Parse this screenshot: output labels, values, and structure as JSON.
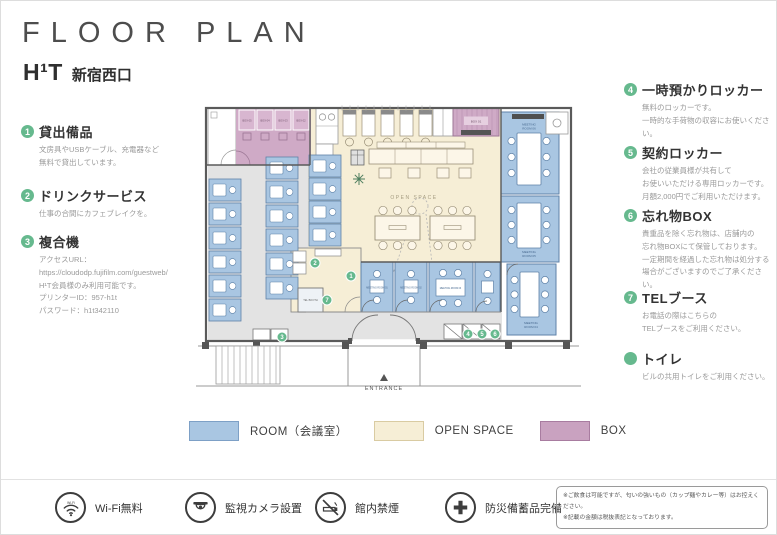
{
  "header": {
    "title": "FLOOR PLAN",
    "brand": "H¹T",
    "location": "新宿西口"
  },
  "features_left": [
    {
      "num": "1",
      "title": "貸出備品",
      "body": "文房具やUSBケーブル、充電器など\n無料で貸出しています。"
    },
    {
      "num": "2",
      "title": "ドリンクサービス",
      "body": "仕事の合間にカフェブレイクを。"
    },
    {
      "num": "3",
      "title": "複合機",
      "body": "アクセスURL：\nhttps://cloudodp.fujifilm.com/guestweb/\nH¹T会員様のみ利用可能です。\nプリンターID：957-h1t\nパスワード：h1t342110"
    }
  ],
  "features_right": [
    {
      "num": "4",
      "title": "一時預かりロッカー",
      "body": "無料のロッカーです。\n一時的な手荷物の収容にお使いください。"
    },
    {
      "num": "5",
      "title": "契約ロッカー",
      "body": "会社の従業員様が共有して\nお使いいただける専用ロッカーです。\n月額2,000円でご利用いただけます。"
    },
    {
      "num": "6",
      "title": "忘れ物BOX",
      "body": "貴重品を除く忘れ物は、店舗内の\n忘れ物BOXにて保管しております。\n一定期間を経過した忘れ物は処分する\n場合がございますのでご了承ください。"
    },
    {
      "num": "7",
      "title": "TELブース",
      "body": "お電話の際はこちらの\nTELブースをご利用ください。"
    },
    {
      "num": "",
      "title": "トイレ",
      "body": "ビルの共用トイレをご利用ください。"
    }
  ],
  "legend": [
    {
      "label": "ROOM（会議室）",
      "color": "#a9c6e2"
    },
    {
      "label": "OPEN SPACE",
      "color": "#f6eed6"
    },
    {
      "label": "BOX",
      "color": "#c9a2c0"
    }
  ],
  "footer": {
    "items": [
      {
        "icon": "wifi-icon",
        "label": "Wi-Fi無料"
      },
      {
        "icon": "camera-icon",
        "label": "監視カメラ設置"
      },
      {
        "icon": "no-smoking-icon",
        "label": "館内禁煙"
      },
      {
        "icon": "first-aid-icon",
        "label": "防災備蓄品完備"
      }
    ],
    "notes": "※ご飲食は可能ですが、匂いの強いもの（カップ麺やカレー等）はお控えください。\n※記載の金額は税抜表記となっております。"
  },
  "plan": {
    "open_space": "OPEN SPACE",
    "entrance": "ENTRANCE",
    "tel_booth": "TEL BOOTH",
    "boxes": [
      "BOX 05",
      "BOX 04",
      "BOX 03",
      "BOX 02",
      "BOX 01"
    ],
    "rooms_small": [
      "MEETING ROOM 01",
      "MEETING ROOM 02",
      "MEETING ROOM 03"
    ],
    "rooms_right": [
      {
        "l1": "MEETING",
        "l2": "ROOM 04"
      },
      {
        "l1": "MEETING",
        "l2": "ROOM 05"
      },
      {
        "l1": "MEETING",
        "l2": "ROOM 06"
      }
    ],
    "markers": [
      "1",
      "2",
      "3",
      "4",
      "5",
      "6",
      "7"
    ],
    "colors": {
      "room": "#a9c6e2",
      "open_space": "#f6eed6",
      "box": "#c9a2c0",
      "corridor": "#e3e3e3",
      "marker_green": "#66b98e"
    }
  }
}
